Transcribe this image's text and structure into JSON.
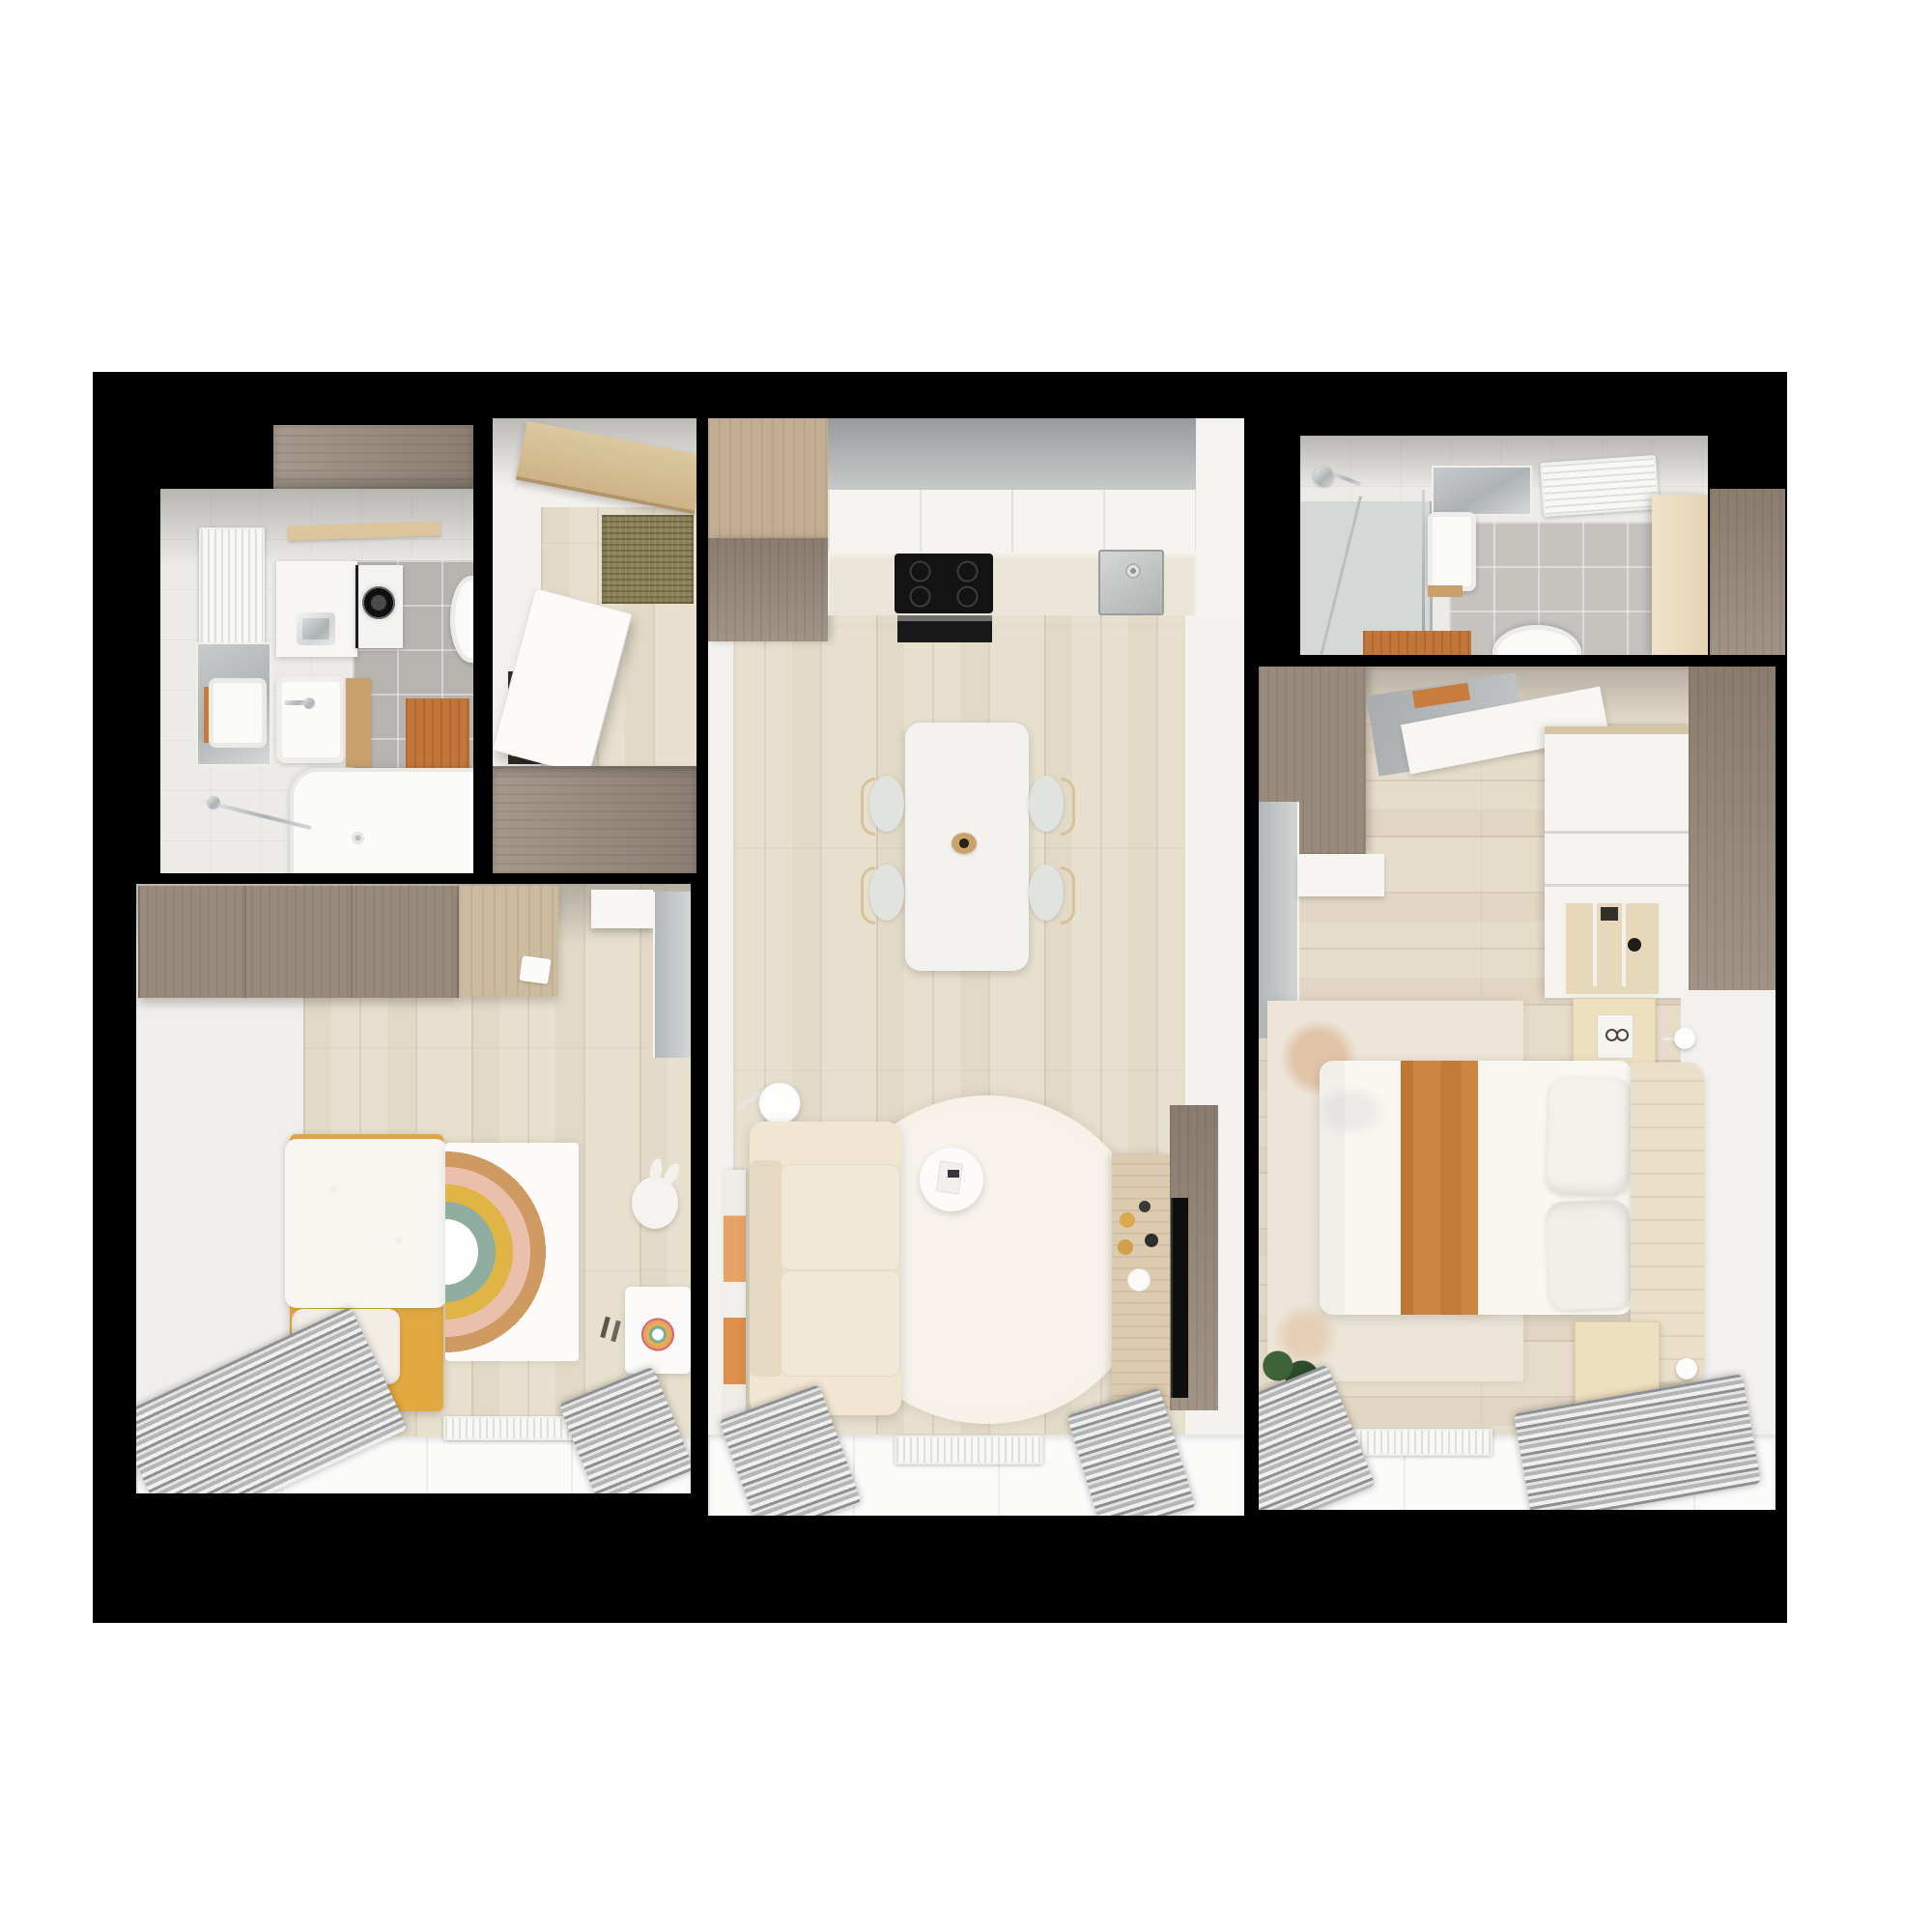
{
  "scene": {
    "type": "3d-floor-plan-top-view",
    "description": "Top-down 3D architectural render of a two-bedroom apartment; rooms cut into a solid black wall mass on a white background; no text labels are visible in the image",
    "background_color": "#ffffff",
    "wall_color": "#000000"
  },
  "palette": {
    "floor_wood": "#e8e0cf",
    "taupe_wood": "#9b8d7f",
    "light_wood": "#c3ae93",
    "oak_accent": "#c9a06b",
    "orange_accent": "#c2763a",
    "mustard_yellow": "#e2a940",
    "cream_upholstery": "#ece1cb",
    "olive_mat": "#8b8157",
    "tile_gray": "#b7b4b0",
    "mirror_gray": "#b3b7b9",
    "curtain_gray": "#9a9a9a"
  },
  "rooms": {
    "bathroom_left": {
      "name": "Bathroom with laundry",
      "furniture": [
        "towel radiator",
        "mirror with light",
        "wall cabinet",
        "washing machine",
        "washbasin",
        "vanity washbasin",
        "oak side cabinet",
        "orange wood bath mat",
        "wall-hung toilet",
        "bathtub",
        "chrome towel bar",
        "wood header cabinet"
      ]
    },
    "hallway": {
      "name": "Entry hall",
      "furniture": [
        "wood shelf beam",
        "olive coir doormat",
        "open white door",
        "orange closet interior",
        "taupe wardrobe band"
      ]
    },
    "living_kitchen": {
      "name": "Living room with kitchen",
      "furniture": [
        "tall taupe cabinet",
        "white kitchen cabinets",
        "countertop",
        "induction hob",
        "built-in oven",
        "stainless sink",
        "dining table",
        "four chairs",
        "twig bowl centerpiece",
        "floor lamp",
        "leaning canvas art",
        "cream sofa",
        "round white rug",
        "coffee table",
        "wood TV sideboard",
        "wall-mounted TV on taupe panel",
        "radiator",
        "two gray curtains over window band"
      ]
    },
    "bathroom_right": {
      "name": "Shower bathroom",
      "furniture": [
        "shower head",
        "glass shower partition",
        "mirror",
        "washbasin",
        "towel radiator",
        "wall-hung toilet",
        "orange wood bath mat",
        "open beige door",
        "taupe wardrobe column"
      ]
    },
    "bedroom": {
      "name": "Bedroom",
      "furniture": [
        "taupe wardrobe",
        "leaning floor mirror",
        "white desk",
        "white closet with open shelves",
        "taupe wardrobe column",
        "nightstand with book",
        "second nightstand",
        "two wall lamps",
        "double bed with orange runner",
        "two pillows",
        "channel-tufted headboard",
        "distressed rug",
        "potted plant",
        "radiator",
        "two gray curtains over window band"
      ]
    },
    "kids_room": {
      "name": "Kids room",
      "furniture": [
        "taupe wardrobe band",
        "light wood desk top",
        "white laptop",
        "white shelf",
        "tall mirror",
        "yellow single bed",
        "white duvet",
        "pillow",
        "yellow bench",
        "wall lamp",
        "rainbow rug",
        "bunny chair",
        "kids desk with drawing",
        "desk chair",
        "radiator",
        "two gray curtains over window band"
      ]
    }
  }
}
